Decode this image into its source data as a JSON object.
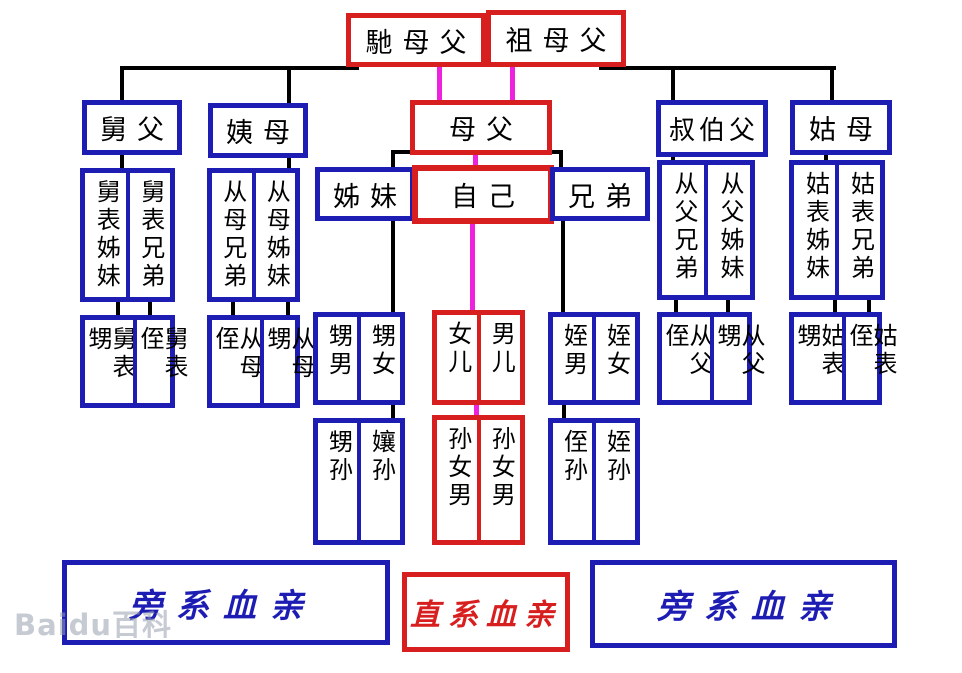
{
  "colors": {
    "blue": "#1d1db4",
    "red": "#d81f1f",
    "magenta": "#ee22dd",
    "line_black": "#000000"
  },
  "watermark": {
    "text": "Baidu百科"
  },
  "nodes": {
    "chimufu": "馳母父",
    "zumufu": "祖母父",
    "jiufu": "舅父",
    "yimu": "姨母",
    "mufu": "母父",
    "shubofu": "叔伯父",
    "gumu": "姑母",
    "zimei": "姊妹",
    "ziji": "自己",
    "xiongdi": "兄弟",
    "jiubiao_zimei": "舅表姊妹",
    "jiubiao_xiongdi": "舅表兄弟",
    "congmu_xiongdi": "从母兄弟",
    "congmu_zimei": "从母姊妹",
    "congfu_xiongdi": "从父兄弟",
    "congfu_zimei": "从父姊妹",
    "gubiao_zimei": "姑表姊妹",
    "gubiao_xiongdi": "姑表兄弟",
    "jiubiao_sheng": "舅表甥",
    "jiubiao_zhi": "舅表侄",
    "congmu_zhi": "从母侄",
    "congmu_sheng": "从母甥",
    "shengnan": "甥男",
    "shengnv": "甥女",
    "nver": "女儿",
    "naner": "男儿",
    "zhinan": "姪男",
    "zhinv": "姪女",
    "congfu_zhi": "从父侄",
    "congfu_sheng": "从父甥",
    "gubiao_sheng": "姑表甥",
    "gubiao_zhi": "姑表侄",
    "shengsun": "甥孙",
    "niangsun": "孃孙",
    "sunnvnan_left": "孙女男",
    "sunnvnan_right": "孙女男",
    "zhisun_left": "侄孙",
    "zhisun_right": "姪孙"
  },
  "legend": {
    "left": "旁系血亲",
    "center": "直系血亲",
    "right": "旁系血亲"
  }
}
